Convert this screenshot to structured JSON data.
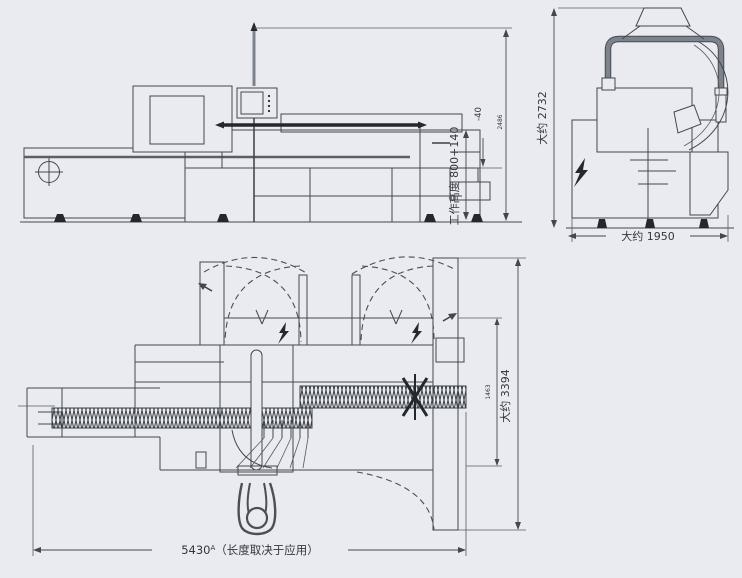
{
  "colors": {
    "background": "#e9ebf0",
    "line": "#43484f",
    "thick_tube_gray": "#7d838c",
    "dark_fill": "#24272c"
  },
  "side_view": {
    "work_height": "工作高度 800+140",
    "work_height_tolerance": "-40",
    "total_height": "2486"
  },
  "front_view": {
    "height": "大约 2732",
    "width": "大约 1950"
  },
  "plan_view": {
    "depth": "大约 3394",
    "inner_width": "1463",
    "length": "5430",
    "length_footnote": "A",
    "length_note": "（长度取决于应用）"
  }
}
